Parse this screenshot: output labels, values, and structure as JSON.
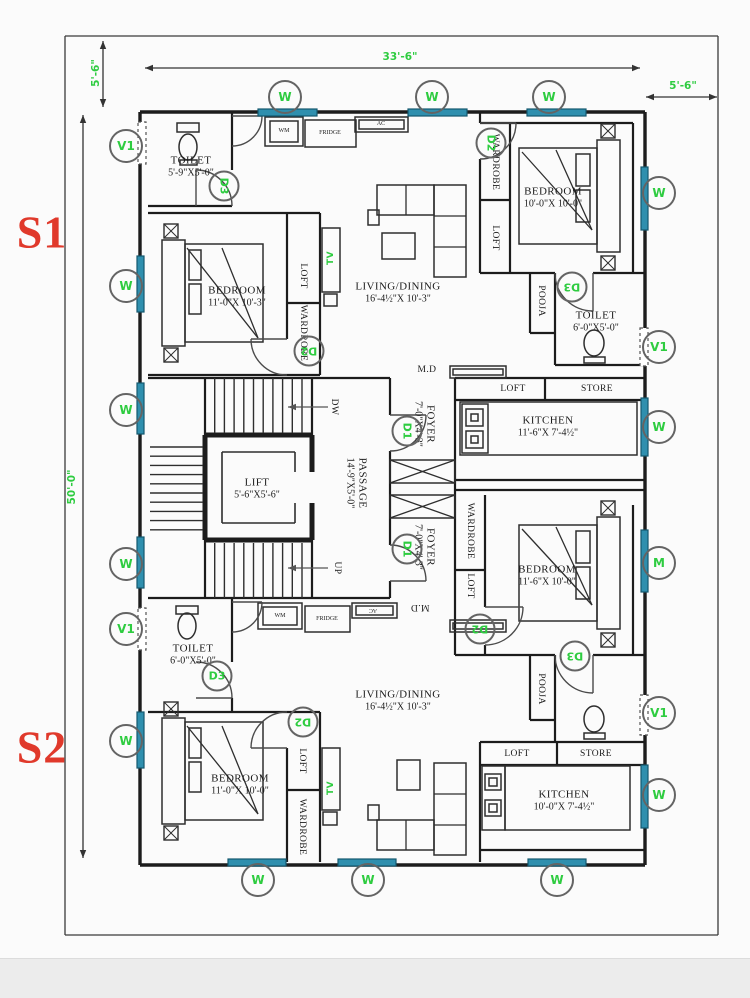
{
  "plan": {
    "unit_s1": "S1",
    "unit_s2": "S2",
    "dim_top": "33'-6\"",
    "dim_top_right": "5'-6\"",
    "dim_top_left": "5'-6\"",
    "dim_left": "50'-0\""
  },
  "colors": {
    "wall": "#1c1c1c",
    "window_teal": "#2f8fae",
    "label_green": "#2ecc40",
    "unit_red": "#e0392b"
  },
  "rooms": [
    {
      "name": "TOILET",
      "dims": "5'-9\"X5'-0\"",
      "x": 191,
      "y": 167
    },
    {
      "name": "BEDROOM",
      "dims": "11'-0\"X 10'-3\"",
      "x": 237,
      "y": 297
    },
    {
      "name": "LIVING/DINING",
      "dims": "16'-4½\"X 10'-3\"",
      "x": 398,
      "y": 293
    },
    {
      "name": "BEDROOM",
      "dims": "10'-0\"X 10'-0\"",
      "x": 553,
      "y": 198
    },
    {
      "name": "TOILET",
      "dims": "6'-0\"X5'-0\"",
      "x": 596,
      "y": 322
    },
    {
      "name": "KITCHEN",
      "dims": "11'-6\"X 7'-4½\"",
      "x": 548,
      "y": 427
    },
    {
      "name": "LIFT",
      "dims": "5'-6\"X5'-6\"",
      "x": 257,
      "y": 489
    },
    {
      "name": "PASSAGE",
      "dims": "14'-9\"X5'-0\"",
      "x": 356,
      "y": 483,
      "rot": 90
    },
    {
      "name": "FOYER",
      "dims": "7'-0\"X4'-3\"",
      "x": 424,
      "y": 424,
      "rot": 90
    },
    {
      "name": "FOYER",
      "dims": "7'-0\"X4'-3\"",
      "x": 424,
      "y": 547,
      "rot": 90
    },
    {
      "name": "TOILET",
      "dims": "6'-0\"X5'-0\"",
      "x": 193,
      "y": 655
    },
    {
      "name": "BEDROOM",
      "dims": "11'-0\"X 10'-0\"",
      "x": 240,
      "y": 785
    },
    {
      "name": "LIVING/DINING",
      "dims": "16'-4½\"X 10'-3\"",
      "x": 398,
      "y": 701
    },
    {
      "name": "BEDROOM",
      "dims": "11'-6\"X 10'-0\"",
      "x": 547,
      "y": 576
    },
    {
      "name": "KITCHEN",
      "dims": "10'-0\"X 7'-4½\"",
      "x": 564,
      "y": 801
    }
  ],
  "small_labels": [
    {
      "text": "LOFT",
      "x": 303,
      "y": 276,
      "rot": 90
    },
    {
      "text": "WARDROBE",
      "x": 303,
      "y": 333,
      "rot": 90
    },
    {
      "text": "TV",
      "x": 331,
      "y": 258,
      "rot": -90,
      "green": true
    },
    {
      "text": "WARDROBE",
      "x": 495,
      "y": 162,
      "rot": 90
    },
    {
      "text": "LOFT",
      "x": 495,
      "y": 238,
      "rot": 90
    },
    {
      "text": "POOJA",
      "x": 541,
      "y": 301,
      "rot": 90
    },
    {
      "text": "M.D",
      "x": 427,
      "y": 370
    },
    {
      "text": "LOFT",
      "x": 513,
      "y": 389
    },
    {
      "text": "STORE",
      "x": 597,
      "y": 389
    },
    {
      "text": "DW",
      "x": 334,
      "y": 407,
      "rot": 90
    },
    {
      "text": "UP",
      "x": 337,
      "y": 568,
      "rot": 90
    },
    {
      "text": "WM",
      "x": 284,
      "y": 131,
      "tiny": true
    },
    {
      "text": "FRIDGE",
      "x": 330,
      "y": 133,
      "tiny": true
    },
    {
      "text": "AC",
      "x": 381,
      "y": 124,
      "tiny": true
    },
    {
      "text": "WM",
      "x": 280,
      "y": 616,
      "tiny": true
    },
    {
      "text": "FRIDGE",
      "x": 327,
      "y": 619,
      "tiny": true
    },
    {
      "text": "AC",
      "x": 373,
      "y": 610,
      "rot": 180,
      "tiny": true
    },
    {
      "text": "M.D",
      "x": 420,
      "y": 607,
      "rot": 180
    },
    {
      "text": "LOFT",
      "x": 302,
      "y": 761,
      "rot": 90
    },
    {
      "text": "WARDROBE",
      "x": 302,
      "y": 827,
      "rot": 90
    },
    {
      "text": "TV",
      "x": 331,
      "y": 788,
      "rot": -90,
      "green": true
    },
    {
      "text": "WARDROBE",
      "x": 470,
      "y": 531,
      "rot": 90
    },
    {
      "text": "LOFT",
      "x": 470,
      "y": 586,
      "rot": 90
    },
    {
      "text": "POOJA",
      "x": 541,
      "y": 689,
      "rot": 90
    },
    {
      "text": "LOFT",
      "x": 517,
      "y": 754
    },
    {
      "text": "STORE",
      "x": 596,
      "y": 754
    }
  ],
  "window_markers": [
    {
      "label": "W",
      "x": 285,
      "y": 97
    },
    {
      "label": "W",
      "x": 432,
      "y": 97
    },
    {
      "label": "W",
      "x": 549,
      "y": 97
    },
    {
      "label": "V1",
      "x": 126,
      "y": 146
    },
    {
      "label": "W",
      "x": 126,
      "y": 286
    },
    {
      "label": "W",
      "x": 126,
      "y": 410
    },
    {
      "label": "W",
      "x": 126,
      "y": 564
    },
    {
      "label": "V1",
      "x": 126,
      "y": 629
    },
    {
      "label": "W",
      "x": 126,
      "y": 741
    },
    {
      "label": "W",
      "x": 659,
      "y": 193
    },
    {
      "label": "V1",
      "x": 659,
      "y": 347
    },
    {
      "label": "W",
      "x": 659,
      "y": 427
    },
    {
      "label": "M",
      "x": 659,
      "y": 563
    },
    {
      "label": "V1",
      "x": 659,
      "y": 713
    },
    {
      "label": "W",
      "x": 659,
      "y": 795
    },
    {
      "label": "W",
      "x": 258,
      "y": 880
    },
    {
      "label": "W",
      "x": 368,
      "y": 880
    },
    {
      "label": "W",
      "x": 557,
      "y": 880
    }
  ],
  "door_markers": [
    {
      "label": "D3",
      "x": 224,
      "y": 186,
      "rot": 90
    },
    {
      "label": "D2",
      "x": 491,
      "y": 143,
      "rot": 90
    },
    {
      "label": "D2",
      "x": 309,
      "y": 351,
      "rot": 180
    },
    {
      "label": "D1",
      "x": 407,
      "y": 431,
      "rot": 90
    },
    {
      "label": "D3",
      "x": 572,
      "y": 287,
      "rot": 180
    },
    {
      "label": "D1",
      "x": 407,
      "y": 549,
      "rot": 90
    },
    {
      "label": "D3",
      "x": 217,
      "y": 676
    },
    {
      "label": "D2",
      "x": 303,
      "y": 722,
      "rot": 180
    },
    {
      "label": "D2",
      "x": 480,
      "y": 629,
      "rot": 180
    },
    {
      "label": "D3",
      "x": 575,
      "y": 656,
      "rot": 180
    }
  ]
}
